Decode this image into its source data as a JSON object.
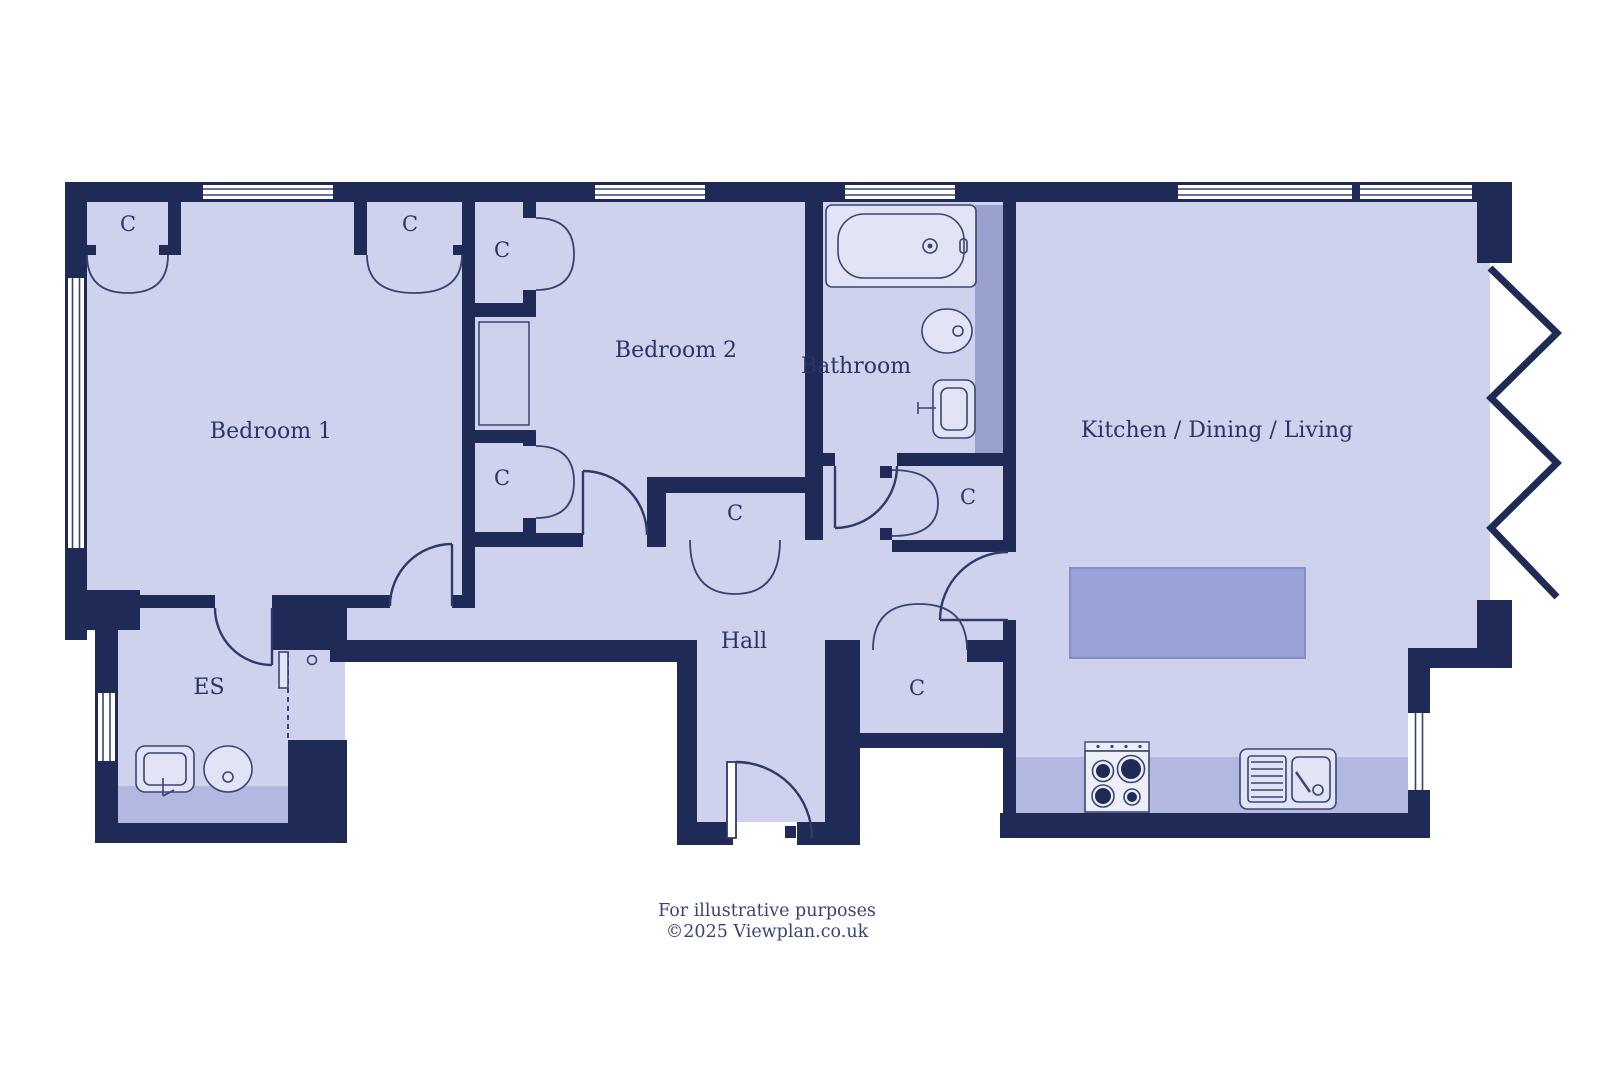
{
  "plan": {
    "rooms": {
      "bedroom1": {
        "label": "Bedroom 1"
      },
      "bedroom2": {
        "label": "Bedroom 2"
      },
      "bathroom": {
        "label": "Bathroom"
      },
      "kitchen": {
        "label": "Kitchen / Dining / Living"
      },
      "hall": {
        "label": "Hall"
      },
      "ensuite": {
        "label": "ES"
      }
    },
    "closets": [
      {
        "label": "C"
      },
      {
        "label": "C"
      },
      {
        "label": "C"
      },
      {
        "label": "C"
      },
      {
        "label": "C"
      },
      {
        "label": "C"
      },
      {
        "label": "C"
      }
    ],
    "colors": {
      "wall": "#1f2a57",
      "floor": "#ced2ed",
      "counter": "#b2b8e0",
      "island": "#9aa1d6",
      "duct_strip": "#99a2ce",
      "fixture_fill": "#e0e4f5",
      "text": "#2b3467"
    }
  },
  "footer": {
    "line1": "For illustrative purposes",
    "line2": "©2025 Viewplan.co.uk"
  }
}
